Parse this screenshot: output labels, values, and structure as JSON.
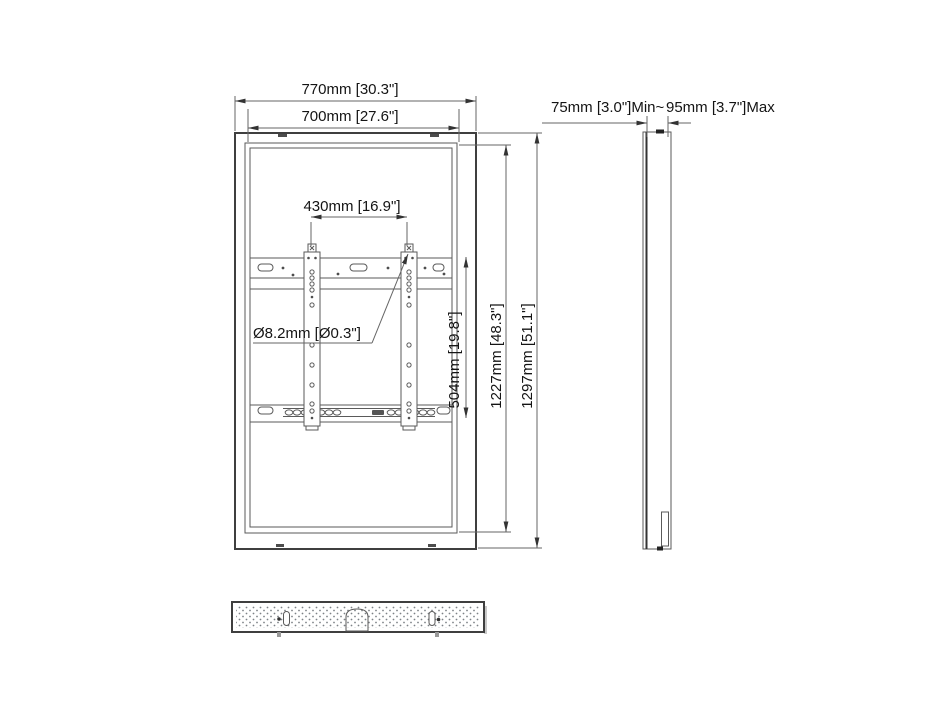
{
  "page": {
    "background": "#ffffff",
    "line_color": "#4a4a4a",
    "text_color": "#141414"
  },
  "front_view": {
    "labels": {
      "outer_width": "770mm [30.3\"]",
      "inner_width": "700mm [27.6\"]",
      "bracket_spacing": "430mm [16.9\"]",
      "hole_diameter": "Ø8.2mm [Ø0.3\"]",
      "bracket_height": "504mm [19.8\"]",
      "inner_height": "1227mm [48.3\"]",
      "outer_height": "1297mm [51.1\"]"
    }
  },
  "side_view": {
    "labels": {
      "depth_min": "75mm [3.0\"]Min~",
      "depth_max": "95mm [3.7\"]Max"
    }
  }
}
